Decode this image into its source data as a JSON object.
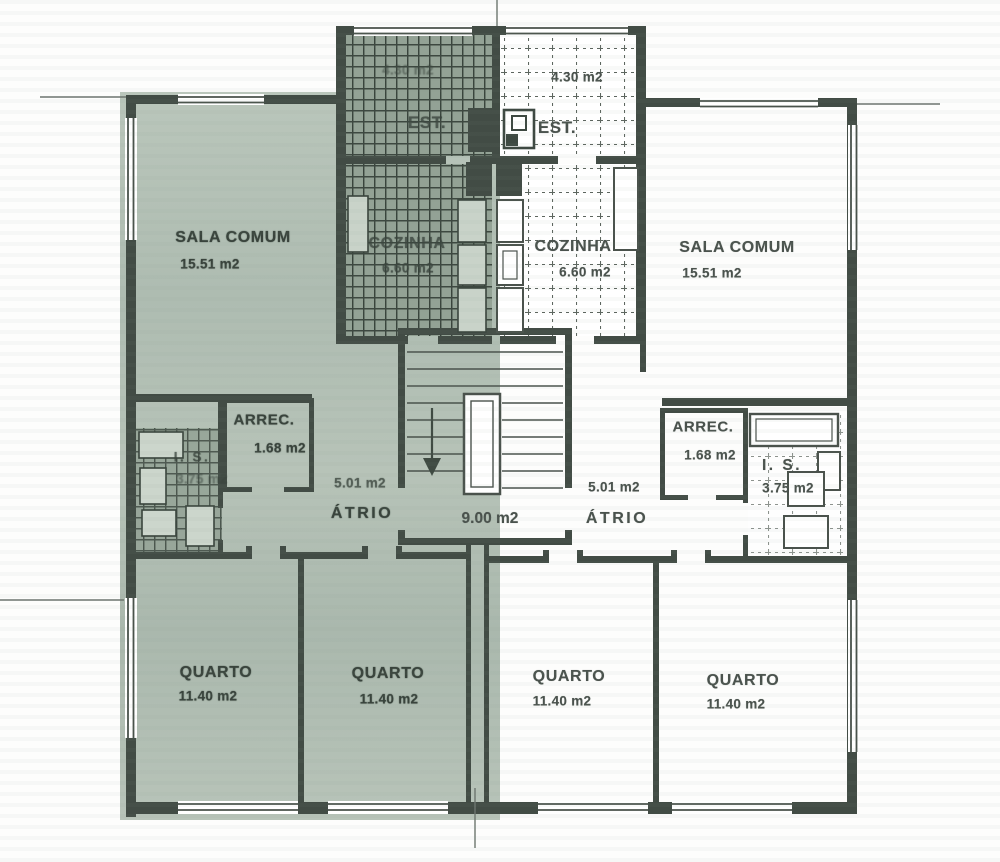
{
  "colors": {
    "left_unit_tint": "#b4c0b5",
    "wall_ink": "#424c45",
    "label_ink_left": "#39433c",
    "label_ink_right": "#4a524d",
    "paper": "#fdfdfc"
  },
  "rooms": {
    "est_left": {
      "name": "EST.",
      "area": "4.30 m2"
    },
    "est_right": {
      "name": "EST.",
      "area": "4.30 m2"
    },
    "sala_comum_left": {
      "name": "SALA COMUM",
      "area": "15.51 m2"
    },
    "sala_comum_right": {
      "name": "SALA COMUM",
      "area": "15.51 m2"
    },
    "cozinha_left": {
      "name": "COZINHA",
      "area": "6.60 m2"
    },
    "cozinha_right": {
      "name": "COZINHA",
      "area": "6.60 m2"
    },
    "arrec_left": {
      "name": "ARREC.",
      "area": "1.68 m2"
    },
    "arrec_right": {
      "name": "ARREC.",
      "area": "1.68 m2"
    },
    "is_left": {
      "name": "I. S.",
      "area": "3.75 m2"
    },
    "is_right": {
      "name": "I. S.",
      "area": "3.75 m2"
    },
    "atrio_left": {
      "name": "ÁTRIO",
      "area": "5.01 m2"
    },
    "atrio_right": {
      "name": "ÁTRIO",
      "area": "5.01 m2"
    },
    "stairwell": {
      "area": "9.00 m2"
    },
    "quarto_left_1": {
      "name": "QUARTO",
      "area": "11.40 m2"
    },
    "quarto_left_2": {
      "name": "QUARTO",
      "area": "11.40 m2"
    },
    "quarto_right_1": {
      "name": "QUARTO",
      "area": "11.40 m2"
    },
    "quarto_right_2": {
      "name": "QUARTO",
      "area": "11.40 m2"
    }
  }
}
